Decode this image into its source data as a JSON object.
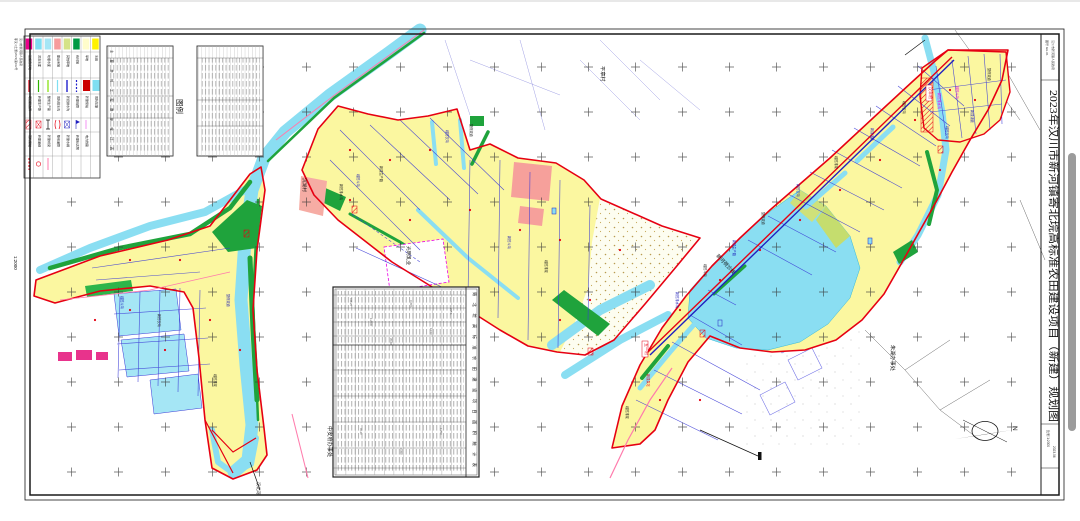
{
  "sheet": {
    "title": "2023年汉川市新河镇寄北垸高标准农田建设项目（新建）规划图",
    "scale_note": "1:2000",
    "scale_text": "比例 1:2000",
    "date": "2023.06",
    "drawing_no": "图号 GH-01",
    "archive_note": "鄂汉川土整(2023)第012号",
    "unit": "汉川市新河镇人民政府"
  },
  "north": {
    "label": "N"
  },
  "legend": {
    "title": "图例",
    "fills": [
      {
        "label": "设施农用地",
        "color": "#EC008C"
      },
      {
        "label": "河流水面",
        "color": "#7FDFF2"
      },
      {
        "label": "坑塘水面",
        "color": "#A5E6F5"
      },
      {
        "label": "建设用地",
        "color": "#F79C9C"
      },
      {
        "label": "其他草地",
        "color": "#D5E388"
      },
      {
        "label": "有林地",
        "color": "#009A44"
      },
      {
        "label": "旱地",
        "color": "#FFFDCB"
      },
      {
        "label": "水田",
        "color": "#FFF200"
      }
    ],
    "lines": [
      {
        "label": "项目区边界",
        "color": "#E60012"
      },
      {
        "label": "新建生产路",
        "color": "#2DB200"
      },
      {
        "label": "整修生产路",
        "color": "#7FE000"
      },
      {
        "label": "现状排水沟",
        "color": "#7FDFF2"
      },
      {
        "label": "新挖排水沟",
        "color": "#2020CC"
      },
      {
        "label": "新建暗管",
        "color": "#2020CC"
      },
      {
        "label": "新建泵站",
        "color": "#CC0000"
      },
      {
        "label": "现状坑塘",
        "color": "#7FDFF2"
      }
    ],
    "symbols": [
      {
        "label": "现状泵站"
      },
      {
        "label": "新建涵闸"
      },
      {
        "label": "新建桥梁"
      },
      {
        "label": "整修涵管"
      },
      {
        "label": "新建水闸"
      },
      {
        "label": "新建标志牌"
      },
      {
        "label": "电力线路"
      }
    ]
  },
  "tables": {
    "top": {
      "title": "主要单体工程数量统计表"
    },
    "mid": {
      "title": "寄北垸高标准农田建设项目面积统计表"
    }
  },
  "map_labels": [
    {
      "t": "平章村",
      "x": 601,
      "y": 66,
      "s": 5.2,
      "c": "#111"
    },
    {
      "t": "朱湖办事处",
      "x": 891,
      "y": 345,
      "s": 5.2,
      "c": "#111"
    },
    {
      "t": "中安府办事处",
      "x": 328,
      "y": 426,
      "s": 5.2,
      "c": "#111"
    },
    {
      "t": "沉湖村",
      "x": 303,
      "y": 178,
      "s": 4.6,
      "c": "#111"
    },
    {
      "t": "光明乳业",
      "x": 407,
      "y": 246,
      "s": 4.8,
      "c": "#111"
    },
    {
      "t": "汉北河",
      "x": 257,
      "y": 482,
      "s": 4.2,
      "c": "#111"
    },
    {
      "t": "新河荷沙线",
      "x": 716,
      "y": 256,
      "s": 5,
      "c": "#111",
      "a": 47
    },
    {
      "t": "新挖排水沟",
      "x": 676,
      "y": 292,
      "s": 3.2,
      "c": "#1A1AB8"
    },
    {
      "t": "疏挖斗沟",
      "x": 704,
      "y": 264,
      "s": 3.2,
      "c": "#222"
    },
    {
      "t": "新建生产路",
      "x": 733,
      "y": 240,
      "s": 3.2,
      "c": "#1A1AB8"
    },
    {
      "t": "整修渠道",
      "x": 762,
      "y": 212,
      "s": 3.2,
      "c": "#222"
    },
    {
      "t": "新挖农沟",
      "x": 797,
      "y": 184,
      "s": 3.2,
      "c": "#1A1AB8"
    },
    {
      "t": "疏挖排渠",
      "x": 835,
      "y": 156,
      "s": 3.2,
      "c": "#222"
    },
    {
      "t": "新建涵管",
      "x": 871,
      "y": 128,
      "s": 3.2,
      "c": "#1A1AB8"
    },
    {
      "t": "疏挖农沟",
      "x": 903,
      "y": 101,
      "s": 3.2,
      "c": "#222"
    },
    {
      "t": "新挖排水沟",
      "x": 938,
      "y": 93,
      "s": 3.2,
      "c": "#E800E8"
    },
    {
      "t": "疏挖斗沟",
      "x": 956,
      "y": 86,
      "s": 3.2,
      "c": "#E800E8"
    },
    {
      "t": "新建涵管",
      "x": 971,
      "y": 110,
      "s": 3.2,
      "c": "#1A1AB8"
    },
    {
      "t": "整修渠道",
      "x": 988,
      "y": 68,
      "s": 3.2,
      "c": "#222"
    },
    {
      "t": "疏挖农沟",
      "x": 946,
      "y": 126,
      "s": 3.2,
      "c": "#1A1AB8"
    },
    {
      "t": "新挖排水沟",
      "x": 340,
      "y": 184,
      "s": 3.2,
      "c": "#222"
    },
    {
      "t": "疏挖斗沟",
      "x": 357,
      "y": 174,
      "s": 3.2,
      "c": "#1A1AB8"
    },
    {
      "t": "新建生产路",
      "x": 380,
      "y": 166,
      "s": 3.2,
      "c": "#222"
    },
    {
      "t": "疏挖农沟",
      "x": 446,
      "y": 130,
      "s": 3.2,
      "c": "#1A1AB8"
    },
    {
      "t": "整修渠道",
      "x": 470,
      "y": 124,
      "s": 3.2,
      "c": "#222"
    },
    {
      "t": "新挖斗沟",
      "x": 508,
      "y": 236,
      "s": 3.2,
      "c": "#1A1AB8"
    },
    {
      "t": "疏挖排渠",
      "x": 545,
      "y": 260,
      "s": 3.2,
      "c": "#222"
    },
    {
      "t": "疏挖斗沟",
      "x": 121,
      "y": 296,
      "s": 3.2,
      "c": "#1A1AB8"
    },
    {
      "t": "新挖农沟",
      "x": 158,
      "y": 314,
      "s": 3.2,
      "c": "#222"
    },
    {
      "t": "整修渠道",
      "x": 227,
      "y": 294,
      "s": 3.2,
      "c": "#1A1AB8"
    },
    {
      "t": "疏挖排渠",
      "x": 214,
      "y": 374,
      "s": 3.2,
      "c": "#222"
    },
    {
      "t": "新建泵站",
      "x": 647,
      "y": 374,
      "s": 3.2,
      "c": "#E60012"
    },
    {
      "t": "疏挖排渠",
      "x": 626,
      "y": 406,
      "s": 3.2,
      "c": "#222"
    },
    {
      "t": "446.25",
      "x": 350,
      "y": 298,
      "s": 2.6,
      "c": "#555"
    },
    {
      "t": "1:2000",
      "x": 370,
      "y": 318,
      "s": 2.6,
      "c": "#555"
    },
    {
      "t": "35.60",
      "x": 390,
      "y": 338,
      "s": 2.6,
      "c": "#555"
    },
    {
      "t": "0.35%",
      "x": 410,
      "y": 300,
      "s": 2.6,
      "c": "#555"
    },
    {
      "t": "12.50",
      "x": 430,
      "y": 328,
      "s": 2.6,
      "c": "#555"
    },
    {
      "t": "235.6",
      "x": 450,
      "y": 308,
      "s": 2.6,
      "c": "#555"
    },
    {
      "t": "45.20",
      "x": 360,
      "y": 428,
      "s": 2.6,
      "c": "#555"
    },
    {
      "t": "0.350",
      "x": 400,
      "y": 448,
      "s": 2.6,
      "c": "#555"
    },
    {
      "t": "1.250",
      "x": 440,
      "y": 428,
      "s": 2.6,
      "c": "#555"
    }
  ],
  "boxed_labels": [
    {
      "t": "五一村",
      "x": 645,
      "y": 343
    },
    {
      "t": "汉丰村",
      "x": 929,
      "y": 87
    }
  ],
  "colors": {
    "boundary": "#E60012",
    "water": "#8ADEF2",
    "field": "#FBF7A0",
    "forest": "#1FA33C",
    "road_pink": "#FF7BAC",
    "ditch_blue": "#3A3AD6",
    "highlight_magenta": "#EE00EE"
  }
}
